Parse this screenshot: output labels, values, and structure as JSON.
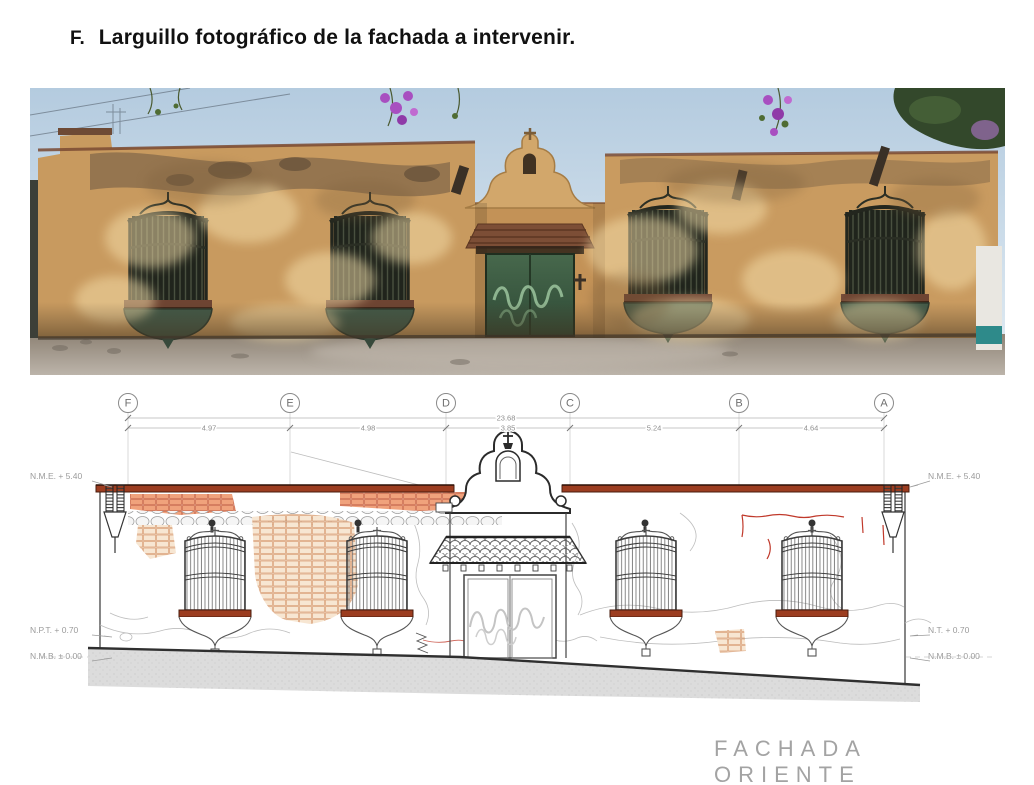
{
  "header": {
    "index": "F.",
    "title": "Larguillo fotográfico de la fachada a intervenir."
  },
  "photo": {
    "alt": "Panoramic photograph of the east facade: weathered ochre adobe house with four wrought-iron window grilles, central green gate under a tiled canopy and a curved bell pediment, blue sky and vegetation above",
    "palette": {
      "sky": "#bcd2e3",
      "wall": "#c89a5f",
      "wall_highlight": "#f2dca8",
      "erosion": "#6b5741",
      "window_iron": "#23261e",
      "window_box_green": "#415948",
      "door_green": "#3d5f45",
      "graffiti": "#9cc49e",
      "canopy": "#7c4e36",
      "street": "#a39a8e",
      "bougainvillea": "#a84fc0",
      "tree": "#33482b"
    }
  },
  "drawing": {
    "grid_axes": [
      "F",
      "E",
      "D",
      "C",
      "B",
      "A"
    ],
    "dimensions": {
      "total": "23.68",
      "segments": [
        "4.97",
        "4.98",
        "3.85",
        "5.24",
        "4.64"
      ]
    },
    "levels": {
      "left": [
        "N.M.E. + 5.40",
        "N.P.T. + 0.70",
        "N.M.B. ± 0.00"
      ],
      "right": [
        "N.M.E. + 5.40",
        "N.T. + 0.70",
        "N.M.B. ± 0.00"
      ]
    },
    "caption": "FACHADA ORIENTE",
    "colors": {
      "cornice": "#9c3d20",
      "sill": "#9c3d20",
      "brick_orange": "#efa57d",
      "brick_tan": "#f6e5d1",
      "crack_red": "#c0392b",
      "ground": "#dcdcdc",
      "line_dark": "#333333",
      "line_light": "#bdbdbd"
    }
  }
}
